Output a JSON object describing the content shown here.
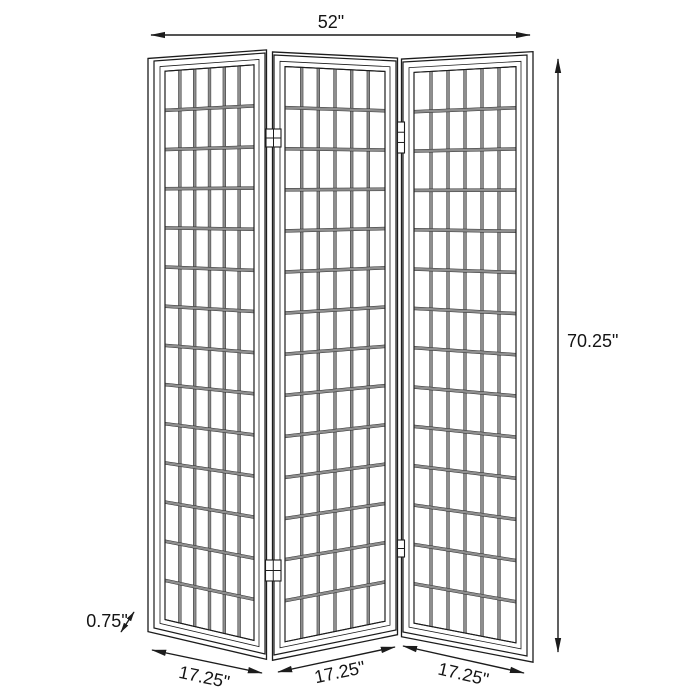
{
  "diagram": {
    "name": "three-panel folding screen dimension diagram",
    "dimensions": {
      "overall_width": "52\"",
      "overall_height": "70.25\"",
      "panel_thickness": "0.75\"",
      "panel_widths": [
        "17.25\"",
        "17.25\"",
        "17.25\""
      ]
    },
    "structure": {
      "panel_count": 3,
      "grid_columns": 6,
      "grid_rows": 14,
      "hinge_count": 4
    },
    "colors": {
      "line": "#1c1c1c",
      "lattice_fill": "#8e8e8e",
      "background": "#ffffff"
    }
  }
}
